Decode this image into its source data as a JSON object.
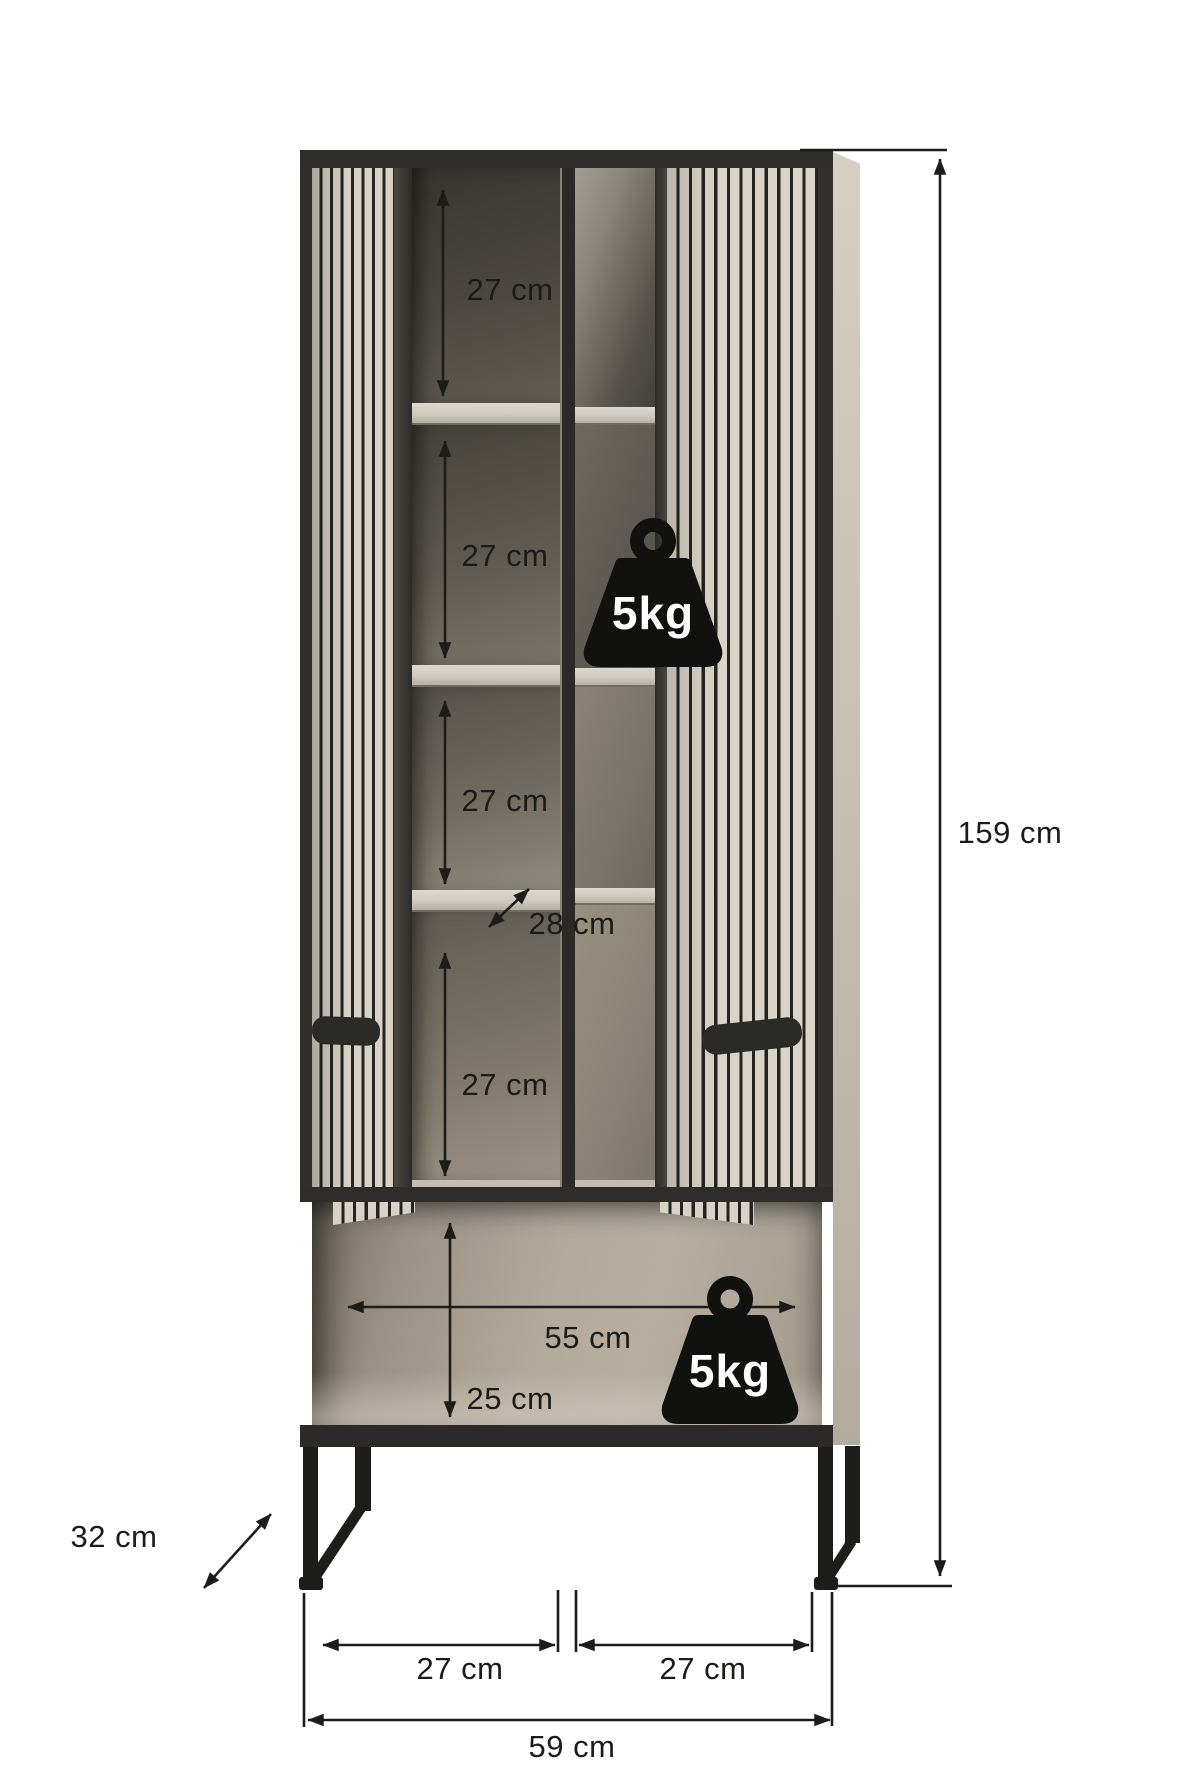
{
  "labels": {
    "compartment_1_height": "27 cm",
    "compartment_2_height": "27 cm",
    "compartment_3_height": "27 cm",
    "compartment_4_height": "27 cm",
    "shelf_depth": "28 cm",
    "open_compartment_width": "55 cm",
    "open_compartment_height": "25 cm",
    "total_height": "159 cm",
    "base_depth": "32 cm",
    "left_door_width": "27 cm",
    "right_door_width": "27 cm",
    "total_width": "59 cm",
    "max_shelf_load": "5kg",
    "max_base_load": "5kg"
  },
  "icons": {
    "upper_weight": "weight-5kg-icon",
    "lower_weight": "weight-5kg-icon"
  },
  "colors": {
    "door_slat": "#d8d2c6",
    "door_groove": "#24231f",
    "frame_dark": "#2e2d2a",
    "interior_dark": "#4b4740",
    "interior_light": "#b2a99b",
    "annotation": "#1c1c1a",
    "load_icon": "#111110",
    "load_text": "#ffffff"
  }
}
